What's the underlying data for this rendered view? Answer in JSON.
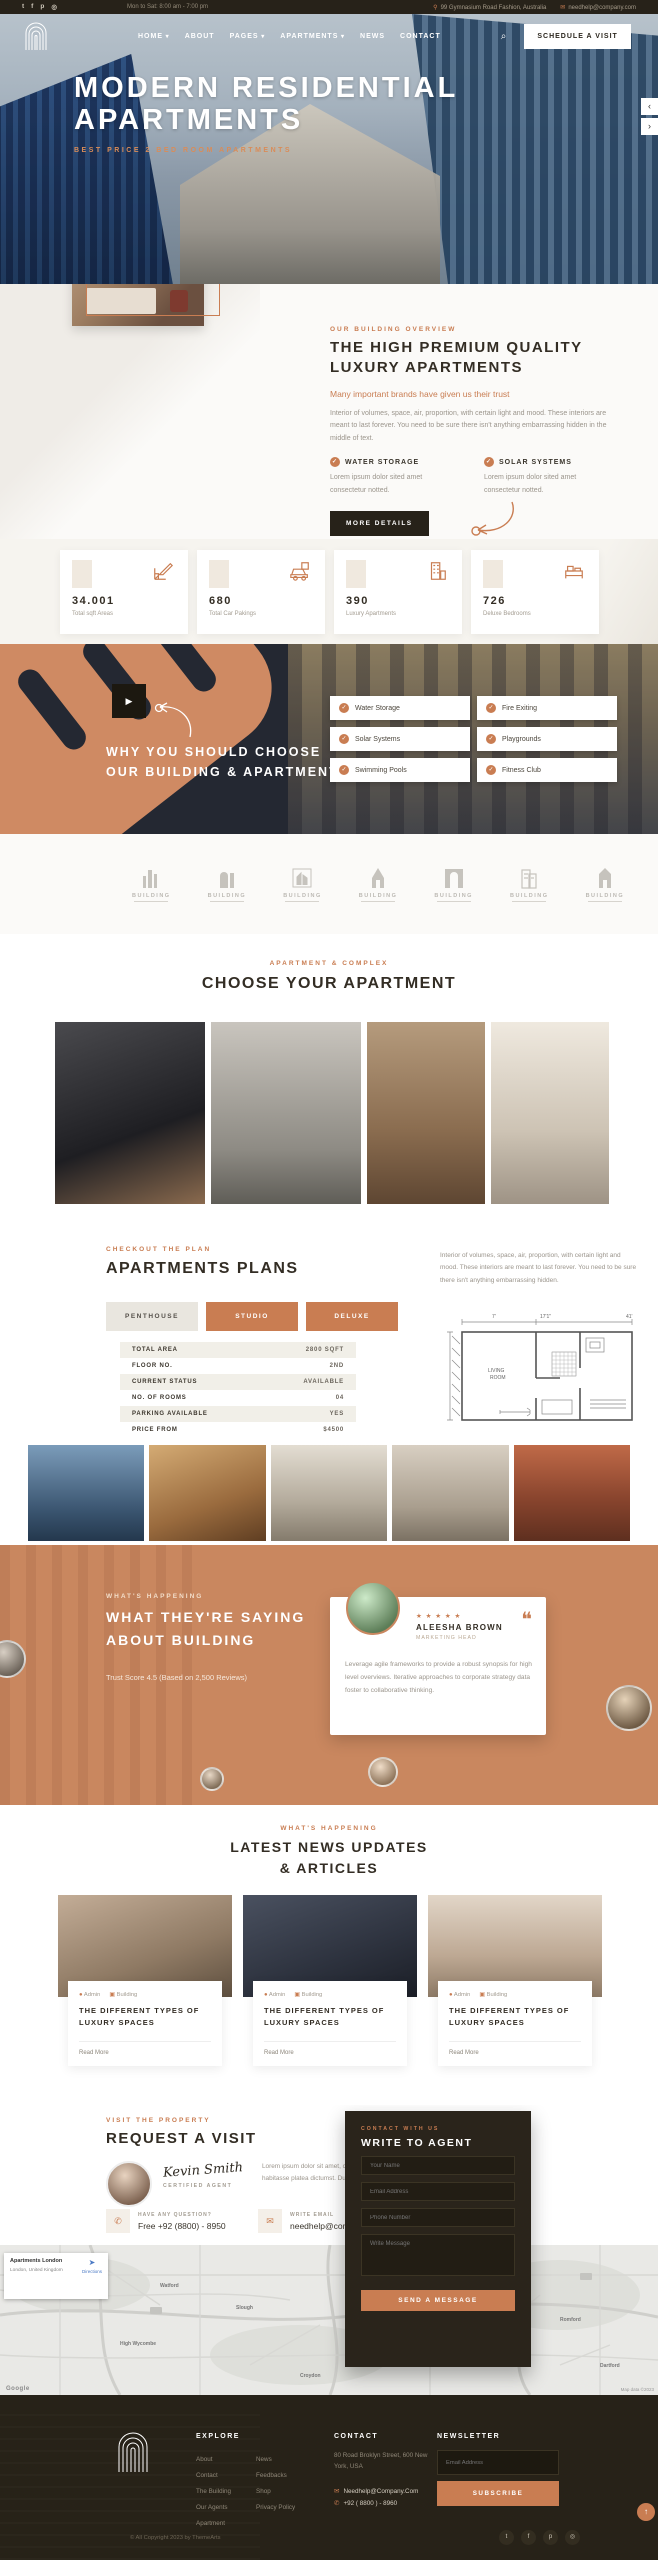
{
  "colors": {
    "accent": "#c97d52",
    "dark": "#272218",
    "testimonial_bg": "#c9875f",
    "heading": "#332d24"
  },
  "topbar": {
    "hours": "Mon to Sat: 8:00 am - 7:00 pm",
    "address": "99 Gymnasium Road Fashion, Australia",
    "email": "needhelp@company.com",
    "socials": [
      "twitter",
      "facebook",
      "pinterest",
      "instagram"
    ]
  },
  "nav": {
    "items": [
      {
        "label": "HOME"
      },
      {
        "label": "ABOUT"
      },
      {
        "label": "PAGES"
      },
      {
        "label": "APARTMENTS"
      },
      {
        "label": "NEWS"
      },
      {
        "label": "CONTACT"
      }
    ],
    "cta": "SCHEDULE A VISIT"
  },
  "hero": {
    "title1": "MODERN RESIDENTIAL",
    "title2": "APARTMENTS",
    "subtitle": "BEST PRICE 2 BED ROOM APARTMENTS"
  },
  "overview": {
    "eyebrow": "OUR BUILDING OVERVIEW",
    "heading1": "THE HIGH PREMIUM QUALITY",
    "heading2": "LUXURY APARTMENTS",
    "lead": "Many important brands have given us their trust",
    "body": "Interior of volumes, space, air, proportion, with certain light and mood. These interiors are meant to last forever. You need to be sure there isn't anything embarrassing hidden in the middle of text.",
    "features": [
      {
        "title": "WATER STORAGE",
        "text": "Lorem ipsum dolor sited amet consectetur notted."
      },
      {
        "title": "SOLAR SYSTEMS",
        "text": "Lorem ipsum dolor sited amet consectetur notted."
      }
    ],
    "cta": "MORE DETAILS"
  },
  "stats": {
    "items": [
      {
        "value": "34.001",
        "label": "Total sqft Areas"
      },
      {
        "value": "680",
        "label": "Total Car Pakings"
      },
      {
        "value": "390",
        "label": "Luxury Apartments"
      },
      {
        "value": "726",
        "label": "Deluxe Bedrooms"
      }
    ]
  },
  "why": {
    "heading1": "WHY YOU SHOULD CHOOSE",
    "heading2": "OUR BUILDING & APARTMENTS",
    "items": [
      "Water Storage",
      "Fire Exiting",
      "Solar Systems",
      "Playgrounds",
      "Swimming Pools",
      "Fitness Club"
    ]
  },
  "logos": {
    "label": "BUILDING",
    "tagline": "REAL ESTATE"
  },
  "choose": {
    "eyebrow": "APARTMENT & COMPLEX",
    "heading": "CHOOSE YOUR APARTMENT"
  },
  "plans": {
    "eyebrow": "CHECKOUT THE PLAN",
    "heading": "APARTMENTS PLANS",
    "description": "Interior of volumes, space, air, proportion, with certain light and mood. These interiors are meant to last forever. You need to be sure there isn't anything embarrassing hidden.",
    "tabs": [
      "PENTHOUSE",
      "STUDIO",
      "DELUXE"
    ],
    "rows": [
      {
        "label": "TOTAL AREA",
        "value": "2800 SQFT"
      },
      {
        "label": "FLOOR NO.",
        "value": "2ND"
      },
      {
        "label": "CURRENT STATUS",
        "value": "AVAILABLE"
      },
      {
        "label": "NO. OF ROOMS",
        "value": "04"
      },
      {
        "label": "PARKING AVAILABLE",
        "value": "YES"
      },
      {
        "label": "PRICE FROM",
        "value": "$4500"
      }
    ],
    "plan_room_label": "LIVING ROOM"
  },
  "testimonials": {
    "eyebrow": "WHAT'S HAPPENING",
    "heading1": "WHAT THEY'RE SAYING",
    "heading2": "ABOUT BUILDING",
    "trust": "Trust Score 4.5 (Based on 2,500 Reviews)",
    "card": {
      "stars": "★ ★ ★ ★ ★",
      "name": "ALEESHA BROWN",
      "role": "MARKETING HEAD",
      "quote": "Leverage agile frameworks to provide a robust synopsis for high level overviews. Iterative approaches to corporate strategy data foster to collaborative thinking."
    }
  },
  "news": {
    "eyebrow": "WHAT'S HAPPENING",
    "heading1": "LATEST NEWS UPDATES",
    "heading2": "& ARTICLES",
    "cards": [
      {
        "author": "Admin",
        "tag": "Building",
        "title": "THE DIFFERENT TYPES OF LUXURY SPACES",
        "link": "Read More"
      },
      {
        "author": "Admin",
        "tag": "Building",
        "title": "THE DIFFERENT TYPES OF LUXURY SPACES",
        "link": "Read More"
      },
      {
        "author": "Admin",
        "tag": "Building",
        "title": "THE DIFFERENT TYPES OF LUXURY SPACES",
        "link": "Read More"
      }
    ]
  },
  "visit": {
    "eyebrow": "VISIT THE PROPERTY",
    "heading": "REQUEST A VISIT",
    "signature": "Kevin Smith",
    "role": "CERTIFIED AGENT",
    "body": "Lorem ipsum dolor sit amet, consecte adipiscing elit. In hac habitasse platea dictumst. Duis porta ultricies.",
    "phone_label": "HAVE ANY QUESTION?",
    "phone": "Free +92 (8800) - 8950",
    "email_label": "WRITE EMAIL",
    "email": "needhelp@company.com"
  },
  "agent_form": {
    "eyebrow": "CONTACT WITH US",
    "heading": "WRITE TO AGENT",
    "fields": [
      "Your Name",
      "Email Address",
      "Phone Number",
      "Write Message"
    ],
    "submit": "SEND A MESSAGE"
  },
  "map": {
    "card_title": "Apartments London",
    "card_sub": "London, United Kingdom",
    "directions": "Directions",
    "google": "Google",
    "attribution": "Map data ©2023",
    "labels": [
      "Watford",
      "Enfield",
      "High Wycombe",
      "Romford",
      "Croydon",
      "Slough",
      "Dartford"
    ]
  },
  "footer": {
    "explore_title": "EXPLORE",
    "links_col1": [
      "About",
      "Contact",
      "The Building",
      "Our Agents",
      "Apartment"
    ],
    "links_col2": [
      "News",
      "Feedbacks",
      "Shop",
      "Privacy Policy"
    ],
    "contact_title": "CONTACT",
    "address": "80 Road Broklyn Street, 600 New York, USA",
    "email": "Needhelp@Company.Com",
    "phone": "+92 ( 8800 ) - 8960",
    "newsletter_title": "NEWSLETTER",
    "email_placeholder": "Email Address",
    "subscribe": "SUBSCRIBE",
    "copyright": "© All Copyright 2023 by ThemeArts"
  }
}
